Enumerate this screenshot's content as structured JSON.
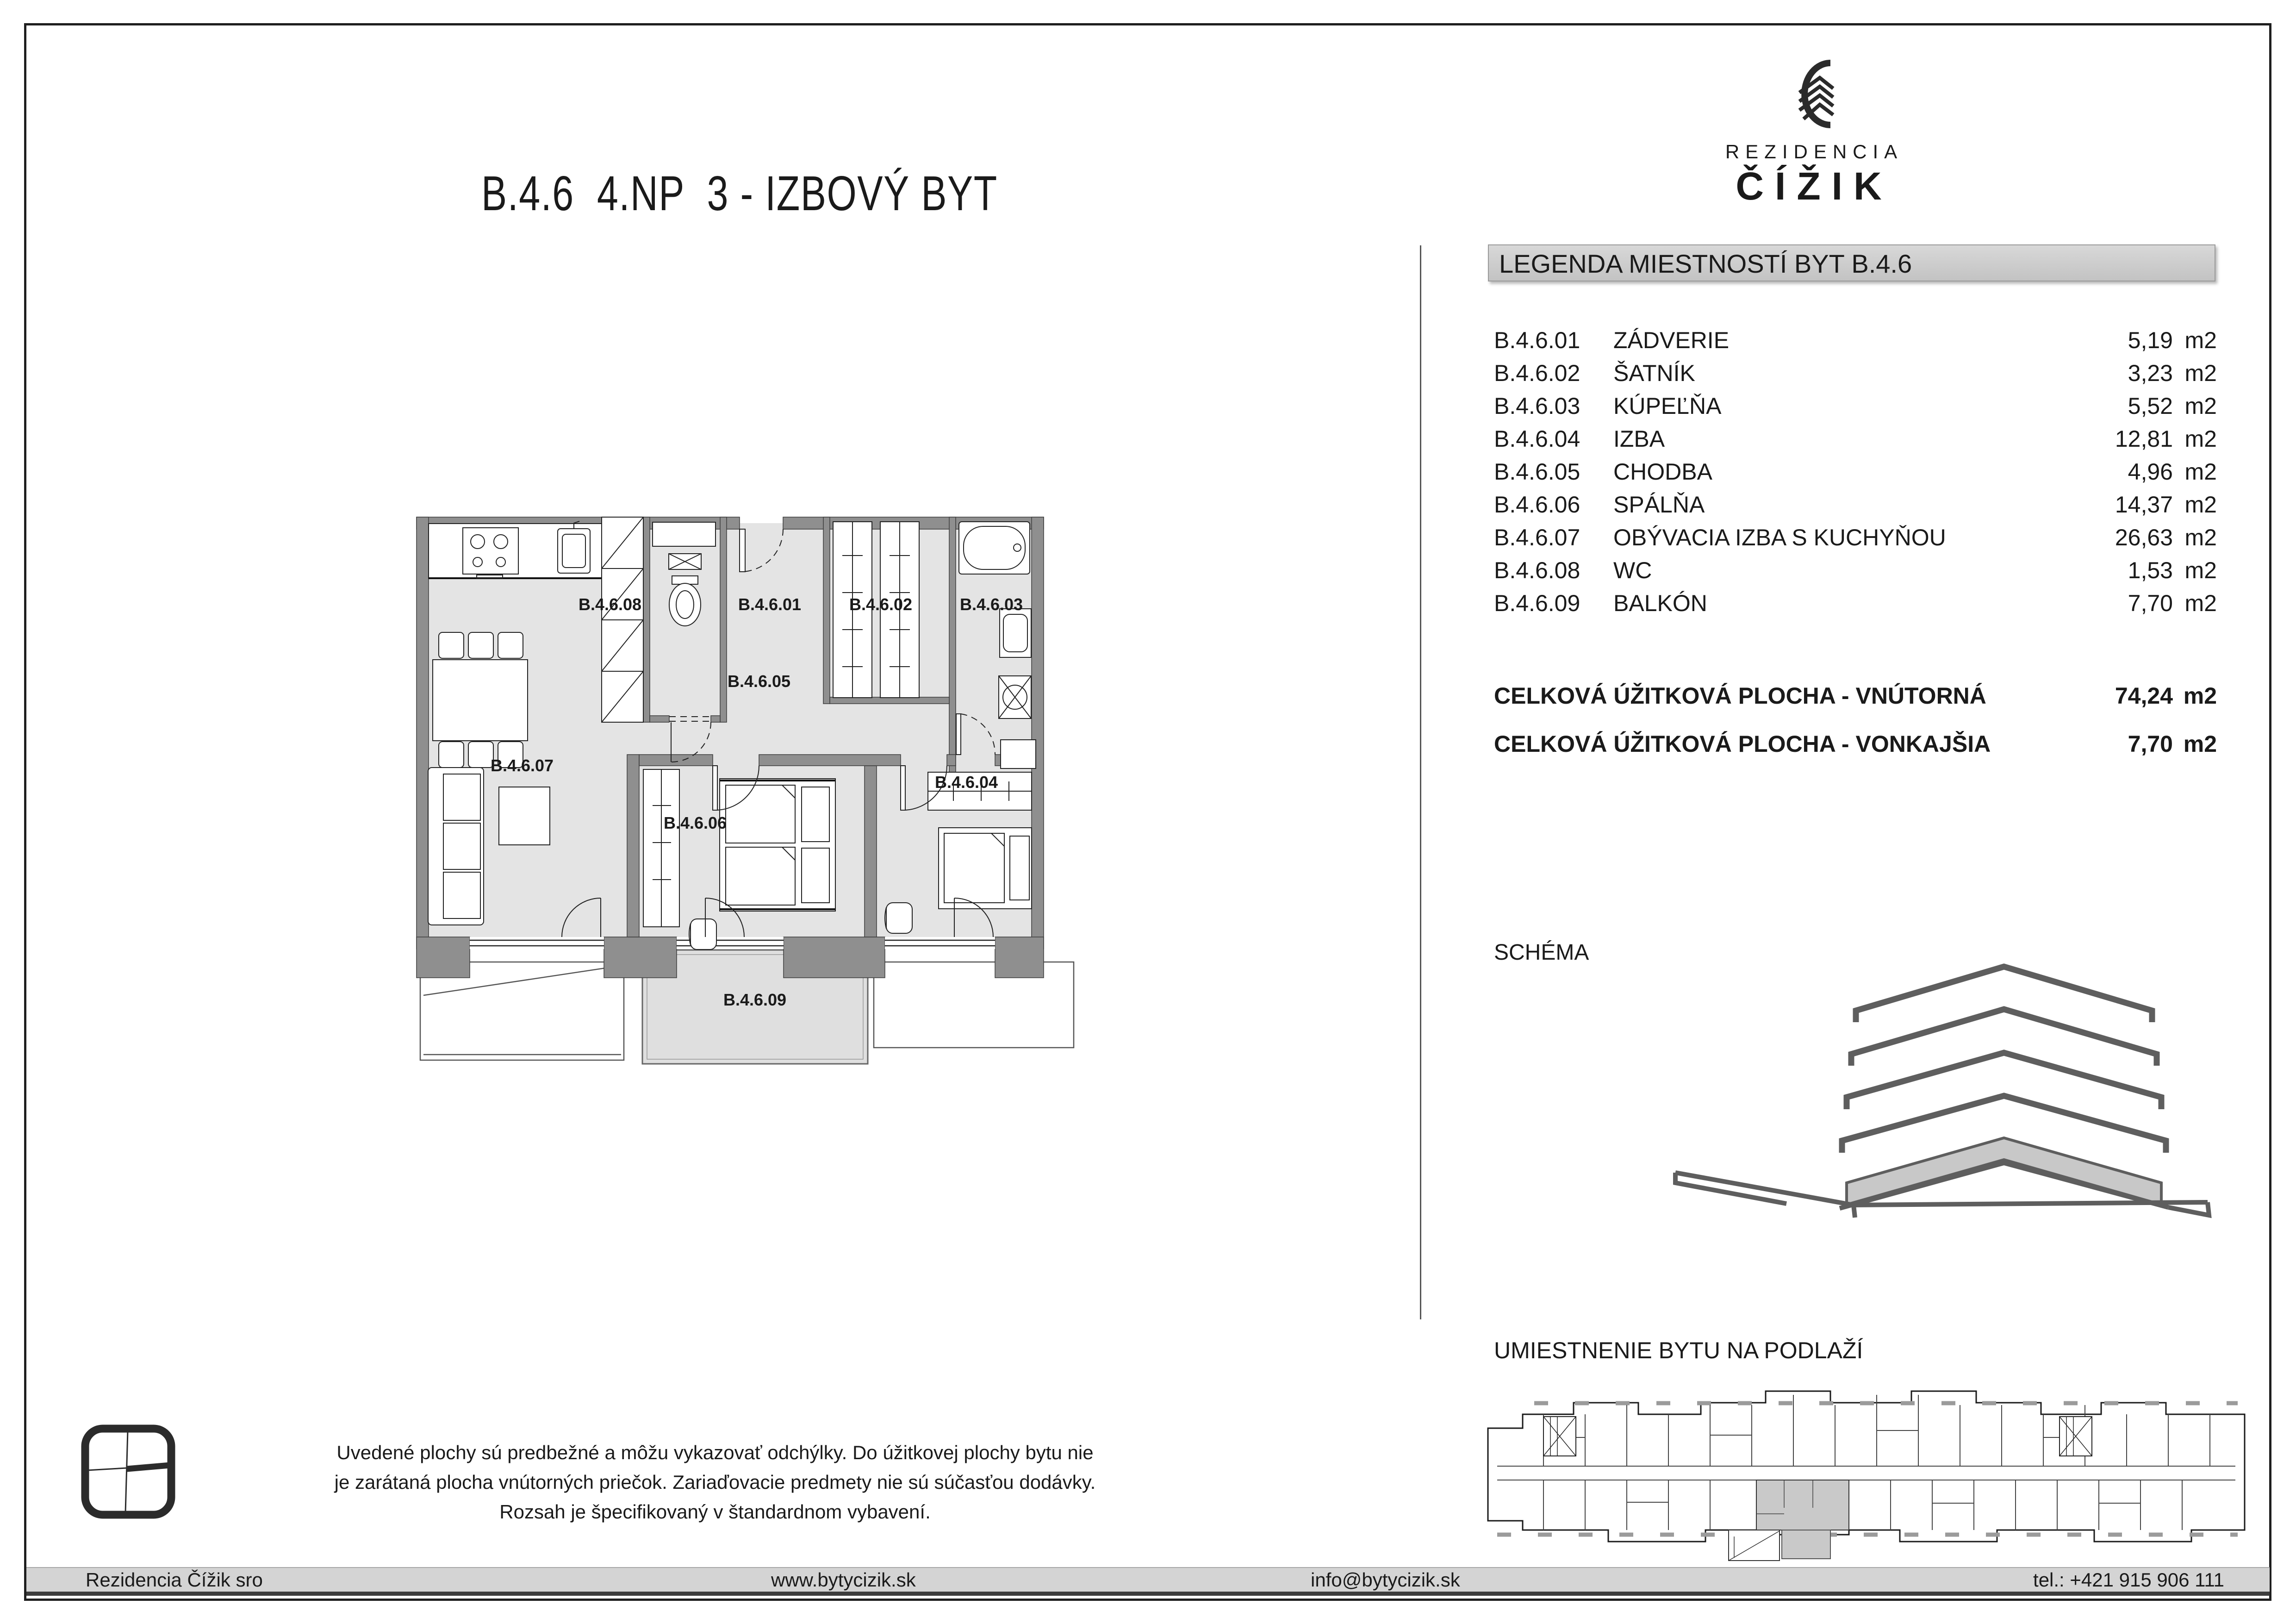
{
  "title": "B.4.6  4.NP  3 - IZBOVÝ BYT",
  "logo": {
    "name_top": "REZIDENCIA",
    "name_bottom": "ČÍŽIK"
  },
  "legend": {
    "header": "LEGENDA MIESTNOSTÍ BYT B.4.6",
    "unit": "m2",
    "rooms": [
      {
        "code": "B.4.6.01",
        "name": "ZÁDVERIE",
        "area": "5,19"
      },
      {
        "code": "B.4.6.02",
        "name": "ŠATNÍK",
        "area": "3,23"
      },
      {
        "code": "B.4.6.03",
        "name": "KÚPEĽŇA",
        "area": "5,52"
      },
      {
        "code": "B.4.6.04",
        "name": "IZBA",
        "area": "12,81"
      },
      {
        "code": "B.4.6.05",
        "name": "CHODBA",
        "area": "4,96"
      },
      {
        "code": "B.4.6.06",
        "name": "SPÁLŇA",
        "area": "14,37"
      },
      {
        "code": "B.4.6.07",
        "name": "OBÝVACIA IZBA S KUCHYŇOU",
        "area": "26,63"
      },
      {
        "code": "B.4.6.08",
        "name": "WC",
        "area": "1,53"
      },
      {
        "code": "B.4.6.09",
        "name": "BALKÓN",
        "area": "7,70"
      }
    ],
    "totals": [
      {
        "label": "CELKOVÁ ÚŽITKOVÁ PLOCHA - VNÚTORNÁ",
        "value": "74,24"
      },
      {
        "label": "CELKOVÁ ÚŽITKOVÁ PLOCHA - VONKAJŠIA",
        "value": "7,70"
      }
    ]
  },
  "sections": {
    "schema": "SCHÉMA",
    "location": "UMIESTNENIE BYTU NA PODLAŽÍ"
  },
  "floorplan": {
    "r01": "B.4.6.01",
    "r02": "B.4.6.02",
    "r03": "B.4.6.03",
    "r04": "B.4.6.04",
    "r05": "B.4.6.05",
    "r06": "B.4.6.06",
    "r07": "B.4.6.07",
    "r08": "B.4.6.08",
    "r09": "B.4.6.09"
  },
  "disclaimer": "Uvedené plochy sú predbežné a môžu vykazovať odchýlky. Do úžitkovej plochy bytu nie je zarátaná plocha vnútorných priečok. Zariaďovacie predmety nie sú súčasťou dodávky. Rozsah je špecifikovaný v štandardnom vybavení.",
  "footer": {
    "company": "Rezidencia Čížik sro",
    "website": "www.bytycizik.sk",
    "email": "info@bytycizik.sk",
    "phone": "tel.: +421 915 906 111"
  },
  "colors": {
    "wall": "#8f8f8f",
    "floor": "#e4e4e4",
    "highlight": "#c9c9c9",
    "legend_bar": "#cccccc",
    "footer_bar": "#d4d4d4"
  }
}
